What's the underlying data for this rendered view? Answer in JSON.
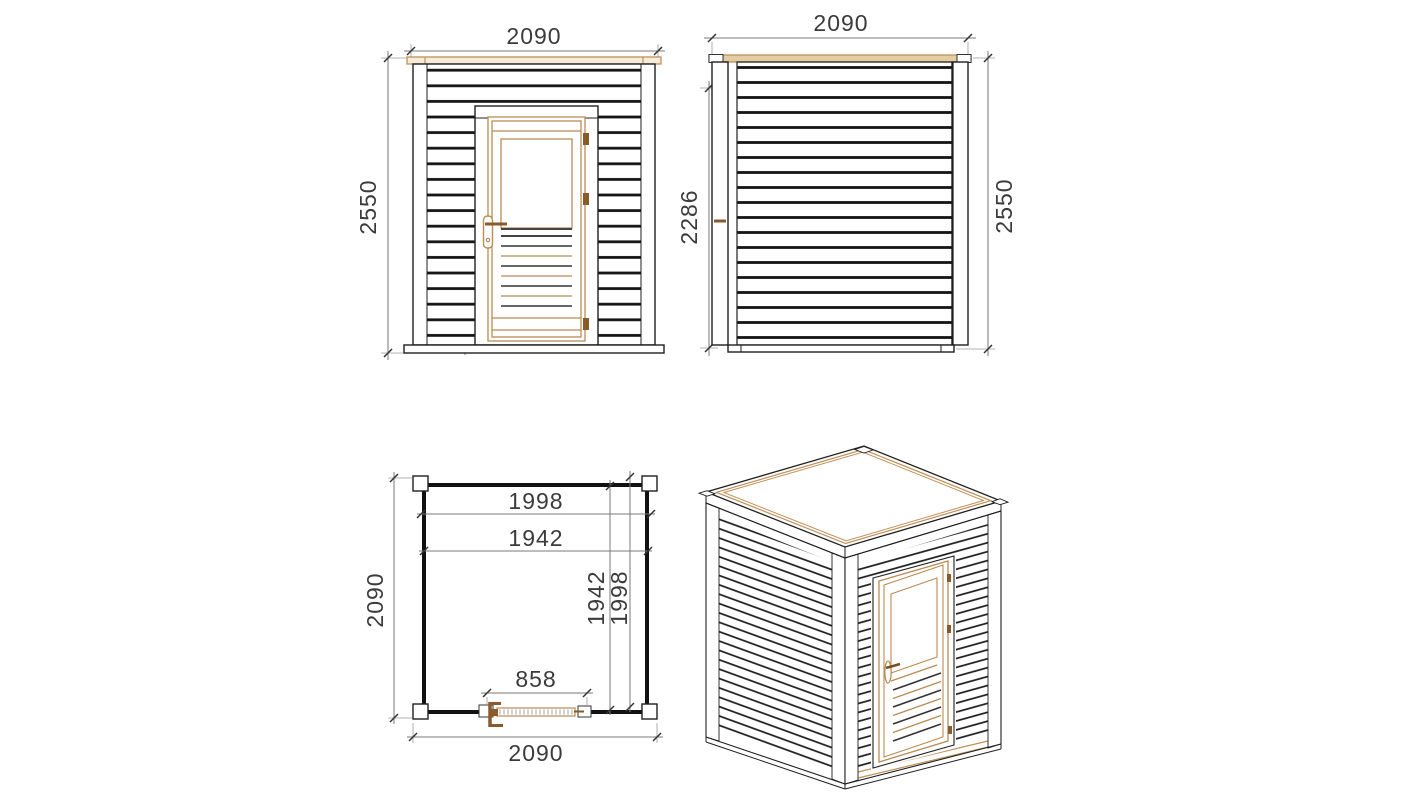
{
  "background": "#ffffff",
  "colors": {
    "outline": "#1f1f1f",
    "plank_gap": "#151515",
    "dimension_line": "#7a7a7a",
    "dimension_text": "#3b3b3b",
    "wood_frame": "#b98b54",
    "wood_trim": "#c09058",
    "wood_dark": "#8a5a2b",
    "roof_strip_fill": "#e3cda4"
  },
  "views": {
    "front_elevation": {
      "dims": {
        "overall_width": "2090",
        "overall_height": "2550",
        "door_height": "2000"
      }
    },
    "rear_elevation": {
      "dims": {
        "overall_width": "2090",
        "wall_height": "2286",
        "overall_height": "2550"
      }
    },
    "floor_plan": {
      "dims": {
        "inner_width_a": "1998",
        "inner_width_b": "1942",
        "inner_depth_a": "1942",
        "inner_depth_b": "1998",
        "door_opening": "858",
        "overall_width": "2090",
        "overall_depth": "2090"
      }
    }
  }
}
